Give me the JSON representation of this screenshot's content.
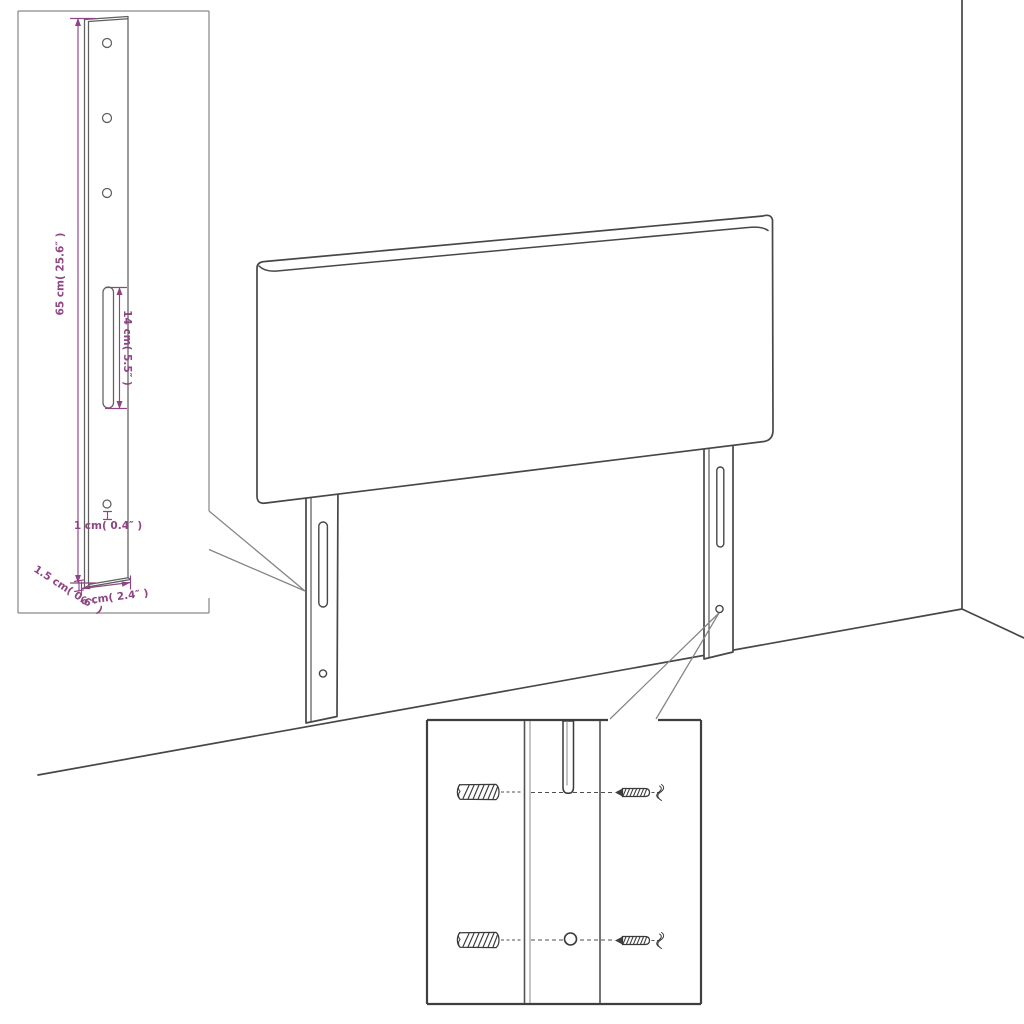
{
  "diagram": {
    "subject": "Headboard with two mounting-leg brackets, wall corner and hardware close-up",
    "background": "#ffffff",
    "line_color": "#474747",
    "dimension_color": "#8e4584"
  },
  "bracket_detail": {
    "height_label": "65 cm( 25.6″ )",
    "slot_label": "14 cm( 5.5″ )",
    "hole_label": "1 cm( 0.4″ )",
    "thickness_label": "1.5 cm( 0.6″ )",
    "width_label": "6 cm( 2.4″ )",
    "hole_count": 4,
    "slot_count": 1
  },
  "hardware_detail": {
    "wall_plug_count": 2,
    "screw_count": 2
  }
}
